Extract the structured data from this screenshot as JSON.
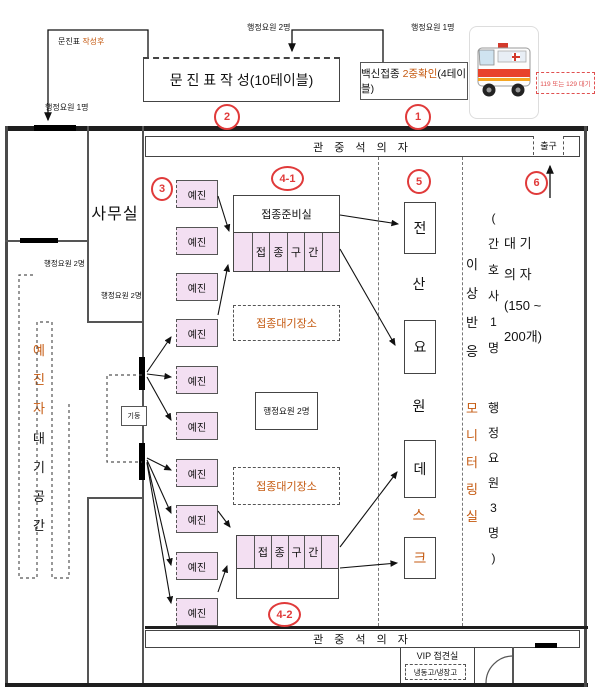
{
  "flow": {
    "after_form_prefix": "문진표 ",
    "after_form_suffix": "작성후",
    "staff_top_left": "행정요원 1명",
    "staff_mid": "행정요원 2명",
    "staff_top_right": "행정요원 1명"
  },
  "stations": {
    "form_box": "문 진 표 작 성(10테이블)",
    "check_prefix": "백신접종 ",
    "check_mid": "2중확인",
    "check_suffix": "(4테이블)"
  },
  "badges": {
    "one": "1",
    "two": "2",
    "three": "3",
    "four_one": "4-1",
    "four_two": "4-2",
    "five": "5",
    "six": "6"
  },
  "ambulance": {
    "caption": "119 또는 129 대기"
  },
  "hall": {
    "top_seats": "관 중 석 의 자",
    "bottom_seats": "관 중 석 의 자",
    "exit": "출구"
  },
  "office": {
    "name": "사무실",
    "staff_a": "행정요원 2명",
    "staff_b": "행정요원 2명",
    "pillar": "기둥"
  },
  "corridor": {
    "label_a": "예진자",
    "label_b": "대기공간"
  },
  "screening": {
    "label": "예진"
  },
  "injection": {
    "prep_room": "접종준비실",
    "zone": [
      "접",
      "종",
      "구",
      "간"
    ],
    "wait_area": "접종대기장소",
    "admin": "행정요원 2명"
  },
  "itdesk": {
    "chars": [
      "전",
      "산",
      "요",
      "원",
      "데",
      "스",
      "크"
    ]
  },
  "monitoring": {
    "left_a": "이상반응",
    "left_b": "모니터링실",
    "right_a": [
      "(",
      "간",
      "호",
      "사",
      "1",
      "명"
    ],
    "right_b": [
      "행",
      "정",
      "요",
      "원",
      "3",
      "명",
      ")"
    ]
  },
  "waiting": {
    "lines": [
      "대 기",
      "의 자",
      "(150 ~",
      "200개)"
    ]
  },
  "vip": {
    "name": "VIP 접견실",
    "fridge": "냉동고/냉장고"
  },
  "colors": {
    "accent_orange": "#c55a11",
    "badge_red": "#e03a3a",
    "pink": "#f3dff2"
  }
}
